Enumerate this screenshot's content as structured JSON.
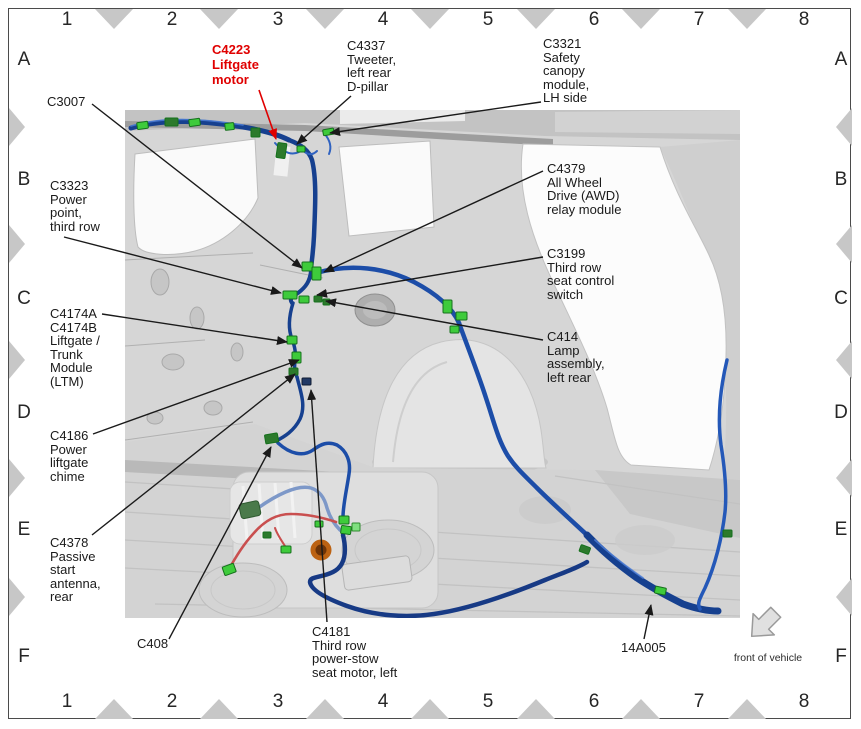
{
  "figure": {
    "type": "vehicle wiring harness connector location diagram",
    "front_of_vehicle": {
      "label": "front of vehicle"
    }
  },
  "colors": {
    "highlight_red": "#e00000",
    "leader_black": "#1a1a1a",
    "harness_blue": "#16408f",
    "connector_green": "#3ecb3b",
    "triangle_grey": "#c7c7c7"
  },
  "grid": {
    "columns": [
      "1",
      "2",
      "3",
      "4",
      "5",
      "6",
      "7",
      "8"
    ],
    "rows": [
      "A",
      "B",
      "C",
      "D",
      "E",
      "F"
    ]
  },
  "layout": {
    "col_x": [
      67,
      172,
      278,
      383,
      488,
      594,
      699,
      804
    ],
    "row_y": [
      60,
      180,
      299,
      413,
      530,
      657
    ],
    "col_bounds": [
      114,
      219,
      325,
      430,
      536,
      641,
      747
    ],
    "row_bounds": [
      127,
      244,
      360,
      478,
      597
    ],
    "num_top": 8,
    "num_bottom": 690,
    "letter_left": 12,
    "letter_right": 829
  },
  "callouts": [
    {
      "id": "c3007",
      "lines": [
        "C3007"
      ],
      "x": 47,
      "y": 95,
      "leader": [
        92,
        104,
        302,
        268
      ]
    },
    {
      "id": "c4223",
      "lines": [
        "C4223",
        "Liftgate",
        "motor"
      ],
      "x": 212,
      "y": 42,
      "color": "#e00000",
      "bold": true,
      "leader": [
        259,
        90,
        276,
        139
      ]
    },
    {
      "id": "c4337",
      "lines": [
        "C4337",
        "Tweeter,",
        "left rear",
        "D-pillar"
      ],
      "x": 347,
      "y": 39,
      "leader": [
        351,
        96,
        297,
        144
      ]
    },
    {
      "id": "c3321",
      "lines": [
        "C3321",
        "Safety",
        "canopy",
        "module,",
        "LH side"
      ],
      "x": 543,
      "y": 37,
      "leader": [
        541,
        102,
        330,
        133
      ]
    },
    {
      "id": "c3323",
      "lines": [
        "C3323",
        "Power",
        "point,",
        "third row"
      ],
      "x": 50,
      "y": 179,
      "leader": [
        64,
        237,
        281,
        293
      ]
    },
    {
      "id": "c4174ab",
      "lines": [
        "C4174A",
        "C4174B",
        "Liftgate /",
        "Trunk",
        "Module",
        "(LTM)"
      ],
      "x": 50,
      "y": 307,
      "leader": [
        102,
        314,
        287,
        342
      ]
    },
    {
      "id": "c4186",
      "lines": [
        "C4186",
        "Power",
        "liftgate",
        "chime"
      ],
      "x": 50,
      "y": 429,
      "leader": [
        93,
        434,
        299,
        360
      ]
    },
    {
      "id": "c4378",
      "lines": [
        "C4378",
        "Passive",
        "start",
        "antenna,",
        "rear"
      ],
      "x": 50,
      "y": 536,
      "leader": [
        92,
        535,
        295,
        374
      ]
    },
    {
      "id": "c408",
      "lines": [
        "C408"
      ],
      "x": 137,
      "y": 637,
      "leader": [
        169,
        639,
        271,
        447
      ]
    },
    {
      "id": "c4181",
      "lines": [
        "C4181",
        "Third row",
        "power-stow",
        "seat motor, left"
      ],
      "x": 312,
      "y": 625,
      "leader": [
        327,
        622,
        311,
        390
      ]
    },
    {
      "id": "c4379",
      "lines": [
        "C4379",
        "All Wheel",
        "Drive (AWD)",
        "relay module"
      ],
      "x": 547,
      "y": 162,
      "leader": [
        543,
        171,
        324,
        272
      ]
    },
    {
      "id": "c3199",
      "lines": [
        "C3199",
        "Third row",
        "seat control",
        "switch"
      ],
      "x": 547,
      "y": 247,
      "leader": [
        543,
        257,
        317,
        295
      ]
    },
    {
      "id": "c414",
      "lines": [
        "C414",
        "Lamp",
        "assembly,",
        "left rear"
      ],
      "x": 547,
      "y": 330,
      "leader": [
        543,
        340,
        326,
        301
      ]
    },
    {
      "id": "14a005",
      "lines": [
        "14A005"
      ],
      "x": 621,
      "y": 641,
      "leader": [
        644,
        639,
        651,
        605
      ]
    }
  ]
}
